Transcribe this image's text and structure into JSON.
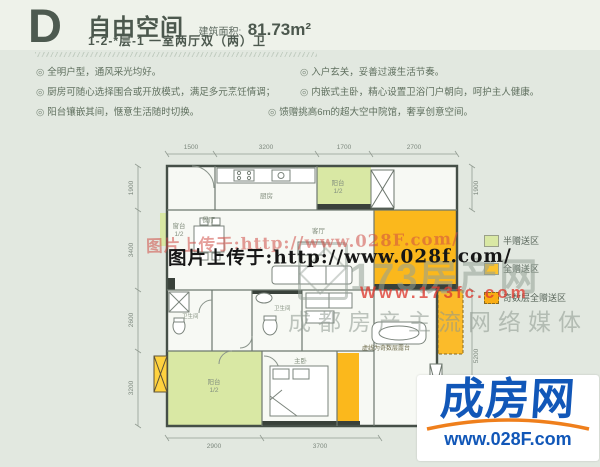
{
  "header": {
    "plan_letter": "D",
    "title": "自由空间",
    "area_label": "建筑面积:",
    "area_value": "81.73m²",
    "subtitle": "1-2-*层-1  一室两厅双（两）卫"
  },
  "features": {
    "marker": "◎",
    "left": [
      "全明户型，通风采光均好。",
      "厨房可随心选择围合或开放模式，满足多元烹饪情调；",
      "阳台镶嵌其间，惬意生活随时切换。"
    ],
    "right": [
      "入户玄关，妥善过渡生活节奏。",
      "内嵌式主卧，精心设置卫浴门户朝向，呵护主人健康。",
      "馈赠挑高6m的超大空中院馆，奢享创意空间。"
    ]
  },
  "plan": {
    "rooms": {
      "kitchen": "厨房",
      "dining": "餐厅",
      "living": "客厅",
      "master": "主卧",
      "bath_left": "卫生间",
      "bath_right": "卫生间",
      "balcony_top": "阳台",
      "balcony_top_frac": "1/2",
      "bay_window": "窗台",
      "bay_window_frac": "1/2",
      "balcony_bottom": "阳台",
      "balcony_bottom_frac": "1/2"
    },
    "dims": {
      "top": [
        "1500",
        "3200",
        "1700",
        "2700"
      ],
      "left": [
        "1900",
        "3400",
        "2600",
        "3200"
      ],
      "right": [
        "1900",
        "5200"
      ],
      "bottom": [
        "2900",
        "3700"
      ]
    },
    "note": "虚线为奇数层露台"
  },
  "legend": {
    "items": [
      {
        "label": "半赠送区",
        "color": "#d9e8a4"
      },
      {
        "label": "全赠送区",
        "color": "#fcc32d"
      },
      {
        "label": "奇数层全赠送区",
        "color": "#f9ad14"
      }
    ]
  },
  "watermarks": {
    "upload_red": "图片上传于:http://www.028F.com/",
    "upload_black": "图片上传于:http://www.028f.com/",
    "brand_name": "173房产网",
    "brand_url": "Www.173fc.com",
    "brand_tagline": "成都房产主流网络媒体"
  },
  "logo": {
    "name": "成房网",
    "url": "www.028F.com"
  },
  "colors": {
    "background": "#e3e9e1",
    "text_dark": "#4c584e",
    "gift_orange": "#fbb81c",
    "half_gift_green": "#d9e8a4",
    "watermark_red": "#d04c46",
    "logo_blue": "#1157b8",
    "logo_orange": "#ef7f1c"
  }
}
